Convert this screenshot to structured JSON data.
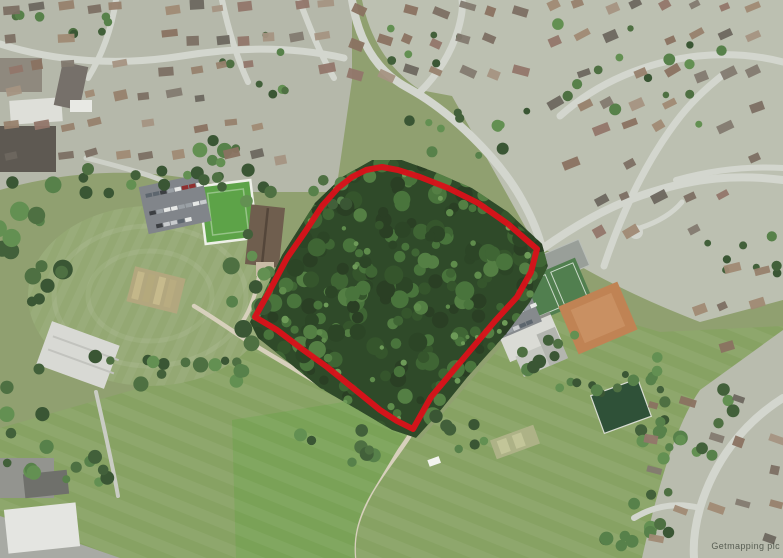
{
  "map": {
    "kind": "aerial-photograph",
    "description": "Aerial photo of suburban area: red boundary outlining central woodland site, cricket ground and bowling green to the west, tennis courts, clay courts and clubhouse to the east, playing fields to the south, housing estates around",
    "watermark": "Getmapping plc",
    "boundary": {
      "color": "#d9121a",
      "stroke_width": 6,
      "points": [
        [
          255,
          317
        ],
        [
          270,
          290
        ],
        [
          287,
          258
        ],
        [
          305,
          232
        ],
        [
          322,
          206
        ],
        [
          338,
          188
        ],
        [
          352,
          177
        ],
        [
          366,
          170
        ],
        [
          382,
          167
        ],
        [
          398,
          170
        ],
        [
          420,
          177
        ],
        [
          448,
          188
        ],
        [
          478,
          203
        ],
        [
          508,
          224
        ],
        [
          530,
          243
        ],
        [
          537,
          249
        ],
        [
          531,
          272
        ],
        [
          517,
          297
        ],
        [
          495,
          321
        ],
        [
          463,
          359
        ],
        [
          431,
          397
        ],
        [
          413,
          429
        ],
        [
          397,
          421
        ],
        [
          380,
          410
        ],
        [
          353,
          388
        ],
        [
          327,
          367
        ],
        [
          302,
          349
        ],
        [
          277,
          330
        ]
      ]
    },
    "palette": {
      "woodland_dark": "#2f4a29",
      "field_green": "#87a263",
      "bright_field": "#7aa257",
      "suburb_gray": "#b6b9ab",
      "road_gray": "#d3d6ce",
      "path_tan": "#d7d0bc",
      "clay_court": "#c08354",
      "tennis_green": "#517f4f",
      "bowling_green": "#5da348"
    }
  }
}
